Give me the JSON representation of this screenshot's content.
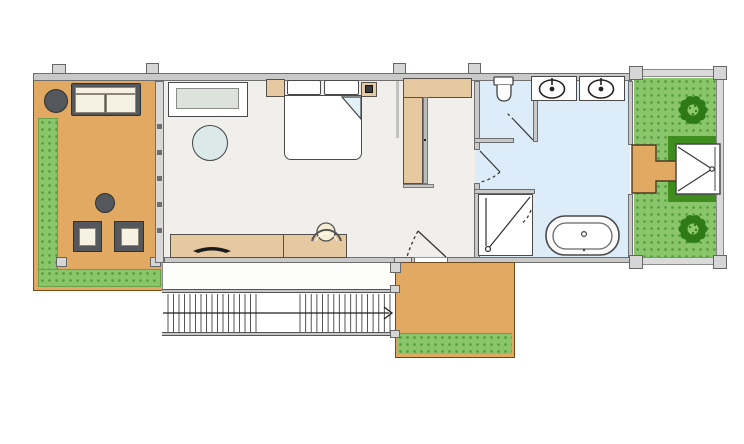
{
  "drawing": {
    "kind": "architectural floor plan, top-down view, no text labels",
    "palette": {
      "wall_gray": "#c9c9c9",
      "wall_outline": "#6e6e6e",
      "interior_floor": "#f0efec",
      "bathroom_floor": "#dcecf8",
      "deck_orange": "#e2a963",
      "wood_furniture_tan": "#e6c9a0",
      "grass_green": "#8bc56b",
      "grass_dot_green": "#4c9c38",
      "hedge_dark_green": "#3f8c1f",
      "tree_green": "#2d7a17",
      "tree_light_green": "#8cc86a",
      "outdoor_furniture_gray": "#54585c",
      "cushion_cream": "#f7f1e2",
      "rug_blue": "#dcE9e9",
      "line_dark": "#333333"
    },
    "rooms": [
      {
        "id": "left-terrace",
        "contents": [
          "round-side-table",
          "outdoor-sofa",
          "round-coffee-table",
          "two-outdoor-chairs",
          "grass-border"
        ]
      },
      {
        "id": "bedroom-living-room",
        "contents": [
          "console-cabinet",
          "round-rug",
          "double-bed-with-pillows",
          "two-nightstands",
          "sideboard-desk",
          "desk-chair"
        ]
      },
      {
        "id": "hallway-closet",
        "contents": [
          "l-shaped-wardrobe"
        ]
      },
      {
        "id": "wc-room",
        "contents": [
          "toilet"
        ]
      },
      {
        "id": "bathroom",
        "contents": [
          "double-sink-counters",
          "walk-in-shower",
          "freestanding-bathtub"
        ]
      },
      {
        "id": "right-garden",
        "contents": [
          "two-bushes",
          "outdoor-shower-pad",
          "stepping-deck-path",
          "hedge-frame"
        ]
      },
      {
        "id": "lower-walkway",
        "contents": []
      },
      {
        "id": "exterior-staircase",
        "contents": [
          "direction-arrow-right"
        ]
      },
      {
        "id": "landing-deck",
        "contents": [
          "grass-strip"
        ]
      }
    ],
    "stairs": {
      "direction": "right",
      "runs": [
        {
          "x0": 168,
          "x1": 256,
          "treads": 17
        },
        {
          "x0": 300,
          "x1": 390,
          "treads": 17
        }
      ],
      "y0": 294,
      "y1": 332
    },
    "counts": {
      "doors_with_swing": 4,
      "windows_mullion_ticks": 5,
      "garden_bushes": 2,
      "sinks": 2
    }
  }
}
